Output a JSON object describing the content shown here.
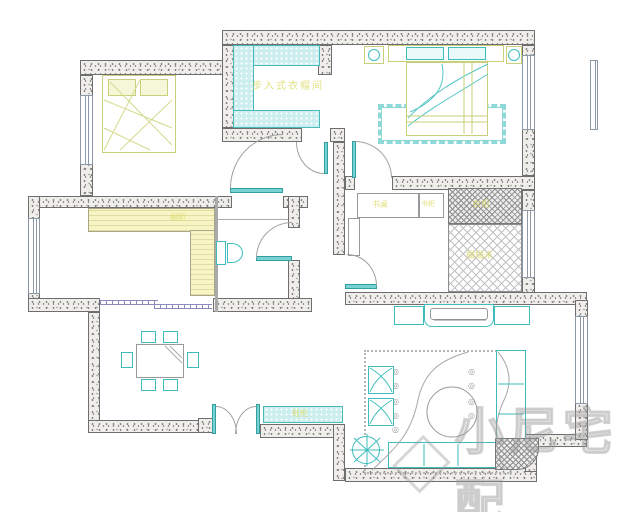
{
  "drawing": {
    "type": "apartment-floor-plan",
    "labels": {
      "walk_in_closet": "步入式衣帽间",
      "wardrobe": "衣柜",
      "tatami": "榻榻米",
      "desk": "书桌",
      "bookcase": "书柜",
      "kitchen_cabinet": "橱柜",
      "shoe_cabinet": "鞋柜"
    },
    "watermark": "小尼宅配",
    "colors": {
      "furniture_outline": "#3fbdbd",
      "wall_speckle": "#8a8a8a",
      "bed_frame_yellow": "#c9cf7a",
      "counter_fill": "#f8f5c4",
      "label_text": "#dcdc6e",
      "storage_fill": "#cdeeee",
      "watermark_gray": "#9a9a9a"
    }
  }
}
